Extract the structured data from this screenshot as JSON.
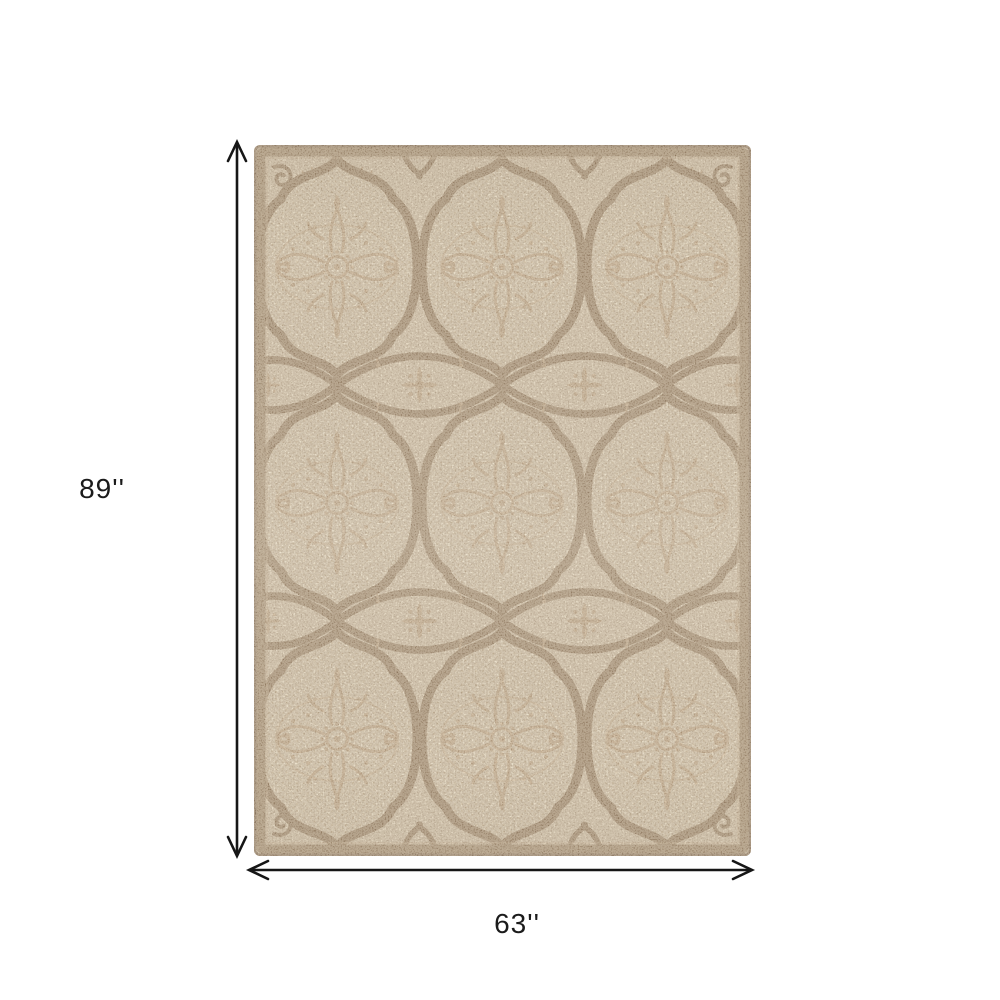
{
  "page": {
    "background": "#ffffff"
  },
  "annotations": {
    "arrow_color": "#161616",
    "label_color": "#1b1b1b",
    "height": {
      "label": "89''"
    },
    "width": {
      "label": "63''"
    }
  },
  "rug": {
    "description": "Cream and tan rectangular area rug with ogee quatrefoil medallions, damask ornament and curved diamond trellis bands",
    "medallion_rows": 3,
    "medallion_columns": 3,
    "colors": {
      "field": "#eadfc9",
      "medallion_fill": "#ece3ce",
      "mesh_dot": "#d7c6a7",
      "ornament": "#c8ad8c",
      "ornament_soft": "#d9c3a4",
      "trellis": "#8d7458",
      "border_band": "#9c8568",
      "edge_line": "#7a6450",
      "speckle_dark": "#6f5840",
      "speckle_light": "#fdf4e1"
    }
  }
}
